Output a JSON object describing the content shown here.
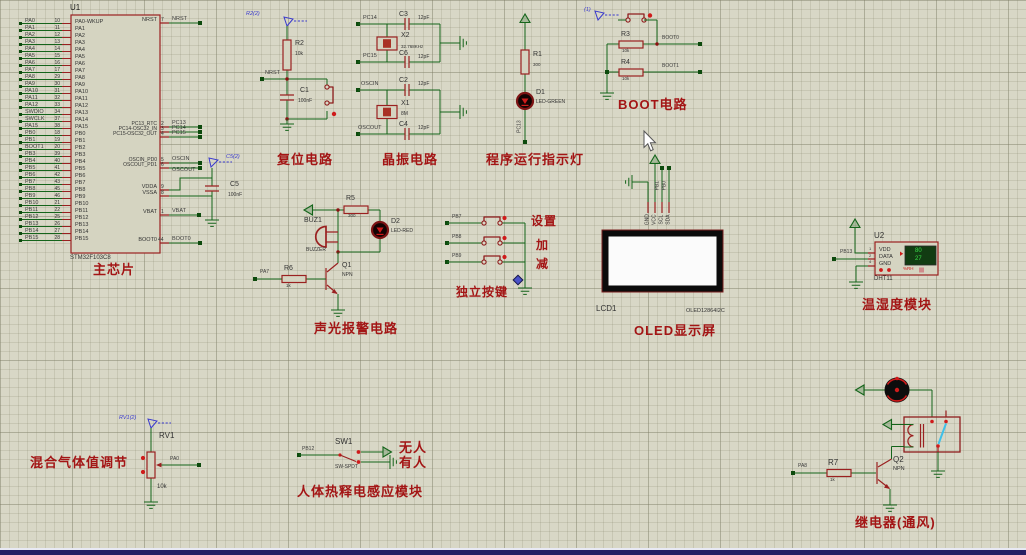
{
  "colors": {
    "background": "#d8d7c6",
    "wire_green": "#14641a",
    "component_red": "#9a2020",
    "label_red": "#a31515",
    "terminal_blue": "#3a3acd",
    "bottom_bar": "#242063"
  },
  "chip": {
    "ref": "U1",
    "part": "STM32F103C8",
    "section_label": "主芯片",
    "pa_pins": [
      {
        "net": "PA0",
        "num": "10",
        "name": "PA0-WKUP"
      },
      {
        "net": "PA1",
        "num": "11",
        "name": "PA1"
      },
      {
        "net": "PA2",
        "num": "12",
        "name": "PA2"
      },
      {
        "net": "PA3",
        "num": "13",
        "name": "PA3"
      },
      {
        "net": "PA4",
        "num": "14",
        "name": "PA4"
      },
      {
        "net": "PA5",
        "num": "15",
        "name": "PA5"
      },
      {
        "net": "PA6",
        "num": "16",
        "name": "PA6"
      },
      {
        "net": "PA7",
        "num": "17",
        "name": "PA7"
      },
      {
        "net": "PA8",
        "num": "29",
        "name": "PA8"
      },
      {
        "net": "PA9",
        "num": "30",
        "name": "PA9"
      },
      {
        "net": "PA10",
        "num": "31",
        "name": "PA10"
      },
      {
        "net": "PA11",
        "num": "32",
        "name": "PA11"
      },
      {
        "net": "PA12",
        "num": "33",
        "name": "PA12"
      },
      {
        "net": "SWDIO",
        "num": "34",
        "name": "PA13"
      },
      {
        "net": "SWCLK",
        "num": "37",
        "name": "PA14"
      },
      {
        "net": "PA15",
        "num": "38",
        "name": "PA15"
      }
    ],
    "pb_pins": [
      {
        "net": "PB0",
        "num": "18",
        "name": "PB0"
      },
      {
        "net": "PB1",
        "num": "19",
        "name": "PB1"
      },
      {
        "net": "BOOT1",
        "num": "20",
        "name": "PB2"
      },
      {
        "net": "PB3",
        "num": "39",
        "name": "PB3"
      },
      {
        "net": "PB4",
        "num": "40",
        "name": "PB4"
      },
      {
        "net": "PB5",
        "num": "41",
        "name": "PB5"
      },
      {
        "net": "PB6",
        "num": "42",
        "name": "PB6"
      },
      {
        "net": "PB7",
        "num": "43",
        "name": "PB7"
      },
      {
        "net": "PB8",
        "num": "45",
        "name": "PB8"
      },
      {
        "net": "PB9",
        "num": "46",
        "name": "PB9"
      },
      {
        "net": "PB10",
        "num": "21",
        "name": "PB10"
      },
      {
        "net": "PB11",
        "num": "22",
        "name": "PB11"
      },
      {
        "net": "PB12",
        "num": "25",
        "name": "PB12"
      },
      {
        "net": "PB13",
        "num": "26",
        "name": "PB13"
      },
      {
        "net": "PB14",
        "num": "27",
        "name": "PB14"
      },
      {
        "net": "PB15",
        "num": "28",
        "name": "PB15"
      }
    ],
    "right_pins": [
      {
        "name": "NRST",
        "num": "7",
        "net": "NRST"
      },
      {
        "name": "PC13_RTC",
        "num": "2",
        "net": "PC13"
      },
      {
        "name": "PC14-OSC32_IN",
        "num": "3",
        "net": "PC14"
      },
      {
        "name": "PC15-OSC32_OUT",
        "num": "4",
        "net": "PC15"
      },
      {
        "name": "OSCIN_PD0",
        "num": "5",
        "net": "OSCIN"
      },
      {
        "name": "OSCOUT_PD1",
        "num": "6",
        "net": "OSCOUT"
      },
      {
        "name": "VDDA",
        "num": "9",
        "net": ""
      },
      {
        "name": "VSSA",
        "num": "8",
        "net": ""
      },
      {
        "name": "VBAT",
        "num": "1",
        "net": "VBAT"
      },
      {
        "name": "BOOT0",
        "num": "44",
        "net": "BOOT0"
      }
    ],
    "c5": {
      "terminal_label": "C5(2)",
      "ref": "C5",
      "value": "100nF"
    }
  },
  "reset": {
    "terminal_label": "R2(2)",
    "r_ref": "R2",
    "r_value": "10k",
    "net": "NRST",
    "c_ref": "C1",
    "c_value": "100nF",
    "section_label": "复位电路"
  },
  "crystal": {
    "net1": "PC14",
    "net2": "PC15",
    "net3": "OSCIN",
    "net4": "OSCOUT",
    "c3": "C3",
    "c3_value": "12pF",
    "c6": "C6",
    "c6_value": "12pF",
    "c2": "C2",
    "c2_value": "12pF",
    "c4": "C4",
    "c4_value": "12pF",
    "x2_ref": "X2",
    "x2_value": "32.768KHz",
    "x1_ref": "X1",
    "x1_value": "8M",
    "section_label": "晶振电路"
  },
  "indicator": {
    "r_ref": "R1",
    "r_value": "300",
    "d_ref": "D1",
    "d_part": "LED-GREEN",
    "net": "PC13",
    "section_label": "程序运行指示灯"
  },
  "boot": {
    "terminal_label": "(1)",
    "r3_ref": "R3",
    "r3_value": "10k",
    "net0": "BOOT0",
    "r4_ref": "R4",
    "r4_value": "10k",
    "net1": "BOOT1",
    "section_label": "BOOT电路"
  },
  "alarm": {
    "r5_ref": "R5",
    "r5_value": "300",
    "buz_ref": "BUZ1",
    "buz_part": "BUZZER",
    "d_ref": "D2",
    "d_part": "LED-RED",
    "q_ref": "Q1",
    "q_part": "NPN",
    "r6_ref": "R6",
    "r6_value": "1k",
    "net": "PA7",
    "section_label": "声光报警电路"
  },
  "keys": {
    "rows": [
      {
        "net": "PB7",
        "label": "设置"
      },
      {
        "net": "PB8",
        "label": "加"
      },
      {
        "net": "PB9",
        "label": "减"
      }
    ],
    "section_label": "独立按键"
  },
  "oled": {
    "ref": "LCD1",
    "part": "OLED12864I2C",
    "pin1": "GND",
    "pin2": "VCC",
    "pin3": "SCL",
    "pin4": "SDA",
    "net1": "PB1",
    "net2": "PB0",
    "section_label": "OLED显示屏"
  },
  "dht": {
    "ref": "U2",
    "part": "DHT11",
    "pin1": "VDD",
    "pin1_num": "1",
    "pin2": "DATA",
    "pin2_num": "2",
    "pin3": "GND",
    "pin3_num": "4",
    "net": "PB13",
    "reading_top": "80",
    "reading_bottom": "27",
    "unit": "%RH",
    "section_label": "温湿度模块"
  },
  "gas": {
    "terminal_label": "RV1(2)",
    "ref": "RV1",
    "value": "10k",
    "net": "PA0",
    "section_label": "混合气体值调节"
  },
  "pir": {
    "ref": "SW1",
    "part": "SW-SPDT",
    "net": "PB12",
    "state_top": "无人",
    "state_bottom": "有人",
    "section_label": "人体热释电感应模块"
  },
  "relay": {
    "r7_ref": "R7",
    "r7_value": "1k",
    "net": "PA8",
    "q_ref": "Q2",
    "q_part": "NPN",
    "section_label": "继电器(通风)"
  }
}
